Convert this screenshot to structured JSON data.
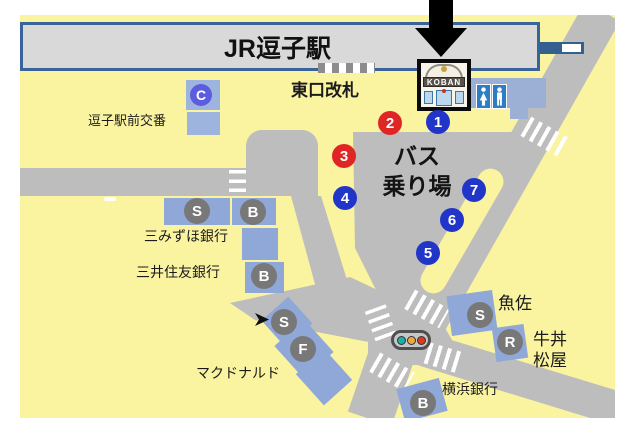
{
  "colors": {
    "page_background": "#ffffff",
    "land": "#faf3a0",
    "road": "#bdbdbd",
    "station_fill": "#d9d9d9",
    "station_border": "#3a639a",
    "building_blue": "#8fa8d8",
    "badge_gray": "#787878",
    "stop_blue": "#2135c8",
    "stop_red": "#e02525",
    "c_badge_violet": "#5c5ce0",
    "toilet_blue": "#2e7cc4",
    "rail_bar_blue": "#33608f",
    "traffic_teal": "#19b2a6",
    "traffic_amber": "#f2a93b",
    "traffic_red": "#e03a1e",
    "arrow_black": "#000000"
  },
  "station": {
    "title": "JR逗子駅"
  },
  "labels": {
    "east_gate": "東口改札",
    "bus_area_line1": "バス",
    "bus_area_line2": "乗り場",
    "police_box": "逗子駅前交番",
    "mizuho_bank": "三みずほ銀行",
    "smbc_bank": "三井住友銀行",
    "mcdonalds": "マクドナルド",
    "uosa": "魚佐",
    "matsuya_line1": "牛丼",
    "matsuya_line2": "松屋",
    "yokohama_bank": "横浜銀行",
    "koban_sign": "KOBAN"
  },
  "bus_stops": [
    {
      "number": "1",
      "color": "blue"
    },
    {
      "number": "2",
      "color": "red"
    },
    {
      "number": "3",
      "color": "red"
    },
    {
      "number": "4",
      "color": "blue"
    },
    {
      "number": "5",
      "color": "blue"
    },
    {
      "number": "6",
      "color": "blue"
    },
    {
      "number": "7",
      "color": "blue"
    }
  ],
  "badges": [
    {
      "letter": "C"
    },
    {
      "letter": "S"
    },
    {
      "letter": "B"
    },
    {
      "letter": "B"
    },
    {
      "letter": "S"
    },
    {
      "letter": "F"
    },
    {
      "letter": "S"
    },
    {
      "letter": "R"
    },
    {
      "letter": "B"
    }
  ],
  "icons": {
    "pointer": "down-arrow-icon",
    "police": "koban-icon",
    "restroom": "restroom-icon",
    "signal": "traffic-light-icon",
    "cursor": "cursor-icon"
  }
}
